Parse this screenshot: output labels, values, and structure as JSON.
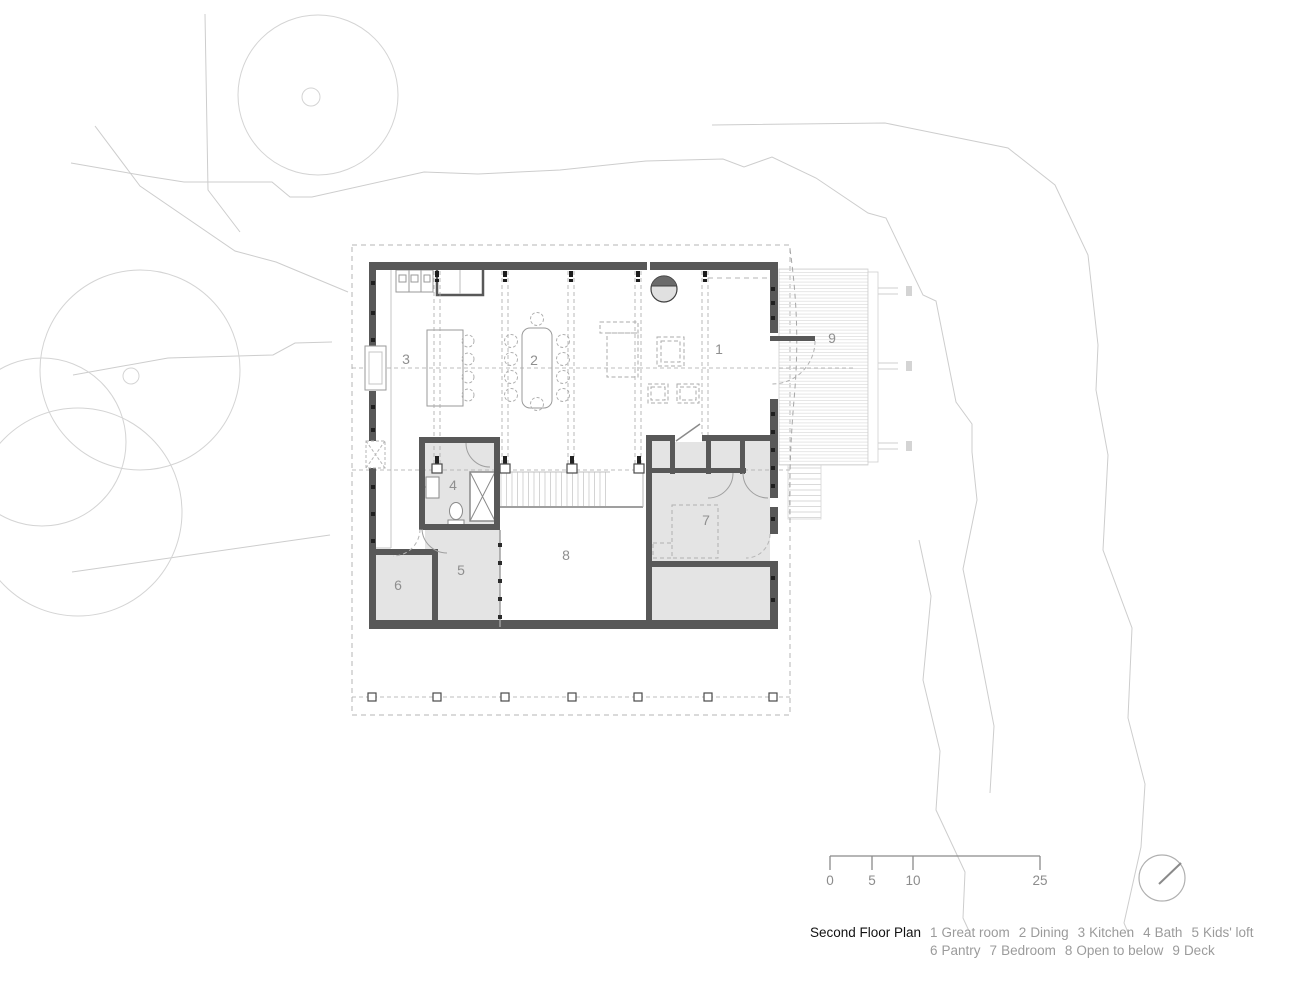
{
  "title": "Second Floor Plan",
  "rooms": [
    {
      "label": "1",
      "name": "Great room"
    },
    {
      "label": "2",
      "name": "Dining"
    },
    {
      "label": "3",
      "name": "Kitchen"
    },
    {
      "label": "4",
      "name": "Bath"
    },
    {
      "label": "5",
      "name": "Kids' loft"
    },
    {
      "label": "6",
      "name": "Pantry"
    },
    {
      "label": "7",
      "name": "Bedroom"
    },
    {
      "label": "8",
      "name": "Open to below"
    },
    {
      "label": "9",
      "name": "Deck"
    }
  ],
  "scale_bar": {
    "labels": [
      "0",
      "5",
      "10",
      "25"
    ]
  },
  "north_arrow": {
    "icon": "north-arrow-circle-needle"
  },
  "colors": {
    "wall": "#585858",
    "room_fill": "#e4e4e4",
    "site_line": "#cdcdcd",
    "grid_line": "#a8a8a8",
    "plan_label_text": "#8f8f8f",
    "legend_text": "#9b9b9b",
    "title_text": "#111111"
  }
}
